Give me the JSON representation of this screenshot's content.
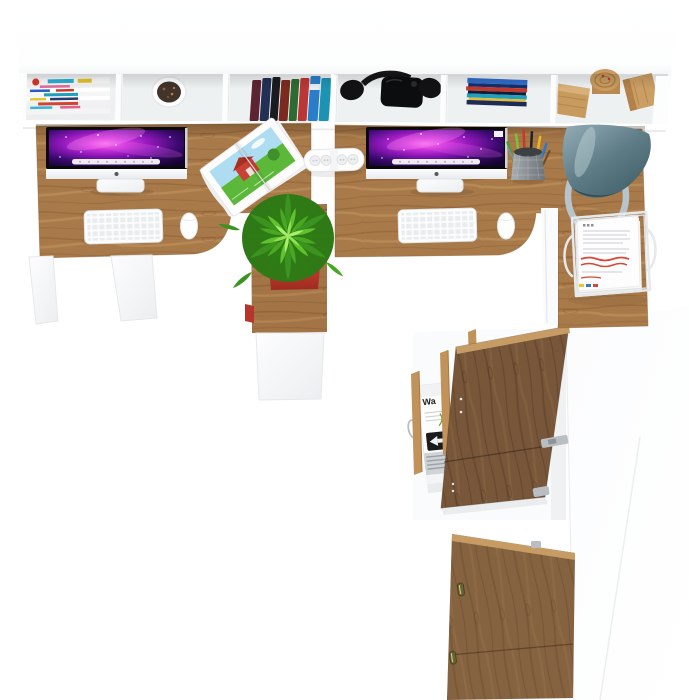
{
  "alt": "Top-down 3D render of a two-person office furniture set: white wall shelf filled with magazines, a plant cup, books, black headphones, CD cases and wooden decor blocks; two oak desks each with an iMac, white keyboard and mouse; an open farm magazine, white power strip, pencil cup, slate desk lamp and a white wire document tray; an oak pedestal with a red potted green plant; below, a white storage cabinet with open oak doors revealing a small white shredder device",
  "labels": {
    "device_label": "Wa"
  },
  "colors": {
    "background": "#ffffff",
    "furniture_white": "#ffffff",
    "furniture_white_shade": "#eef1f2",
    "desk_wood": "#a97a49",
    "desk_wood_dark": "#8a5c33",
    "desk_wood_light": "#c79c66",
    "door_wood": "#77563a",
    "door_wood_dark": "#5a3d25",
    "edge_wood_light": "#c79c64",
    "screen_purple": "#8c17b8",
    "screen_pink": "#ff7df2",
    "screen_dark": "#160430",
    "lamp_slate": "#5d7b85",
    "lamp_ring": "#b7c4c9",
    "plant_green": "#46a226",
    "plant_green_dark": "#2f7a16",
    "plant_green_light": "#8fe052",
    "pot_red": "#c0392b",
    "annotation_red": "#d64838",
    "gear_black": "#121214",
    "cd_blue": "#2f6cc9",
    "book_red": "#bb3736",
    "metal_gray": "#9aa0a4"
  }
}
